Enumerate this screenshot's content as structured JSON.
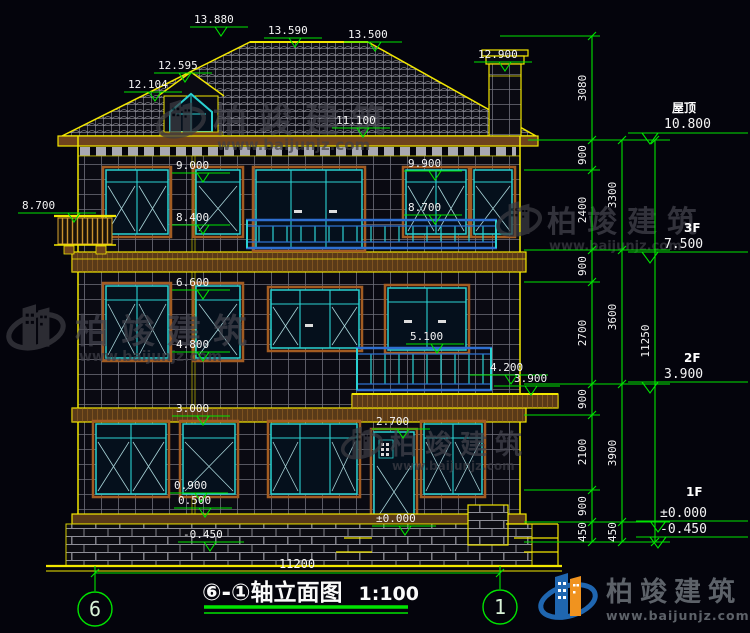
{
  "drawing_title": {
    "prefix": "⑥-①",
    "name": "轴立面图",
    "scale": "1:100"
  },
  "axis": {
    "left_bubble": "6",
    "right_bubble": "1",
    "overall_width": "11200"
  },
  "elevation_markers": [
    {
      "label": "13.880"
    },
    {
      "label": "13.590"
    },
    {
      "label": "13.500"
    },
    {
      "label": "12.900"
    },
    {
      "label": "12.595"
    },
    {
      "label": "12.104"
    },
    {
      "label": "11.100"
    },
    {
      "label": "9.000"
    },
    {
      "label": "9.900"
    },
    {
      "label": "8.700"
    },
    {
      "label": "8.400"
    },
    {
      "label": "8.700"
    },
    {
      "label": "6.600"
    },
    {
      "label": "4.800"
    },
    {
      "label": "5.100"
    },
    {
      "label": "4.200"
    },
    {
      "label": "3.900"
    },
    {
      "label": "3.000"
    },
    {
      "label": "2.700"
    },
    {
      "label": "0.900"
    },
    {
      "label": "0.500"
    },
    {
      "label": "±0.000"
    },
    {
      "label": "-0.450"
    }
  ],
  "right_dimensions": {
    "inner_chain": [
      "3080",
      "900",
      "2400",
      "900",
      "2700",
      "900",
      "2100",
      "900",
      "450"
    ],
    "mid_chain": [
      "3300",
      "3600",
      "3900",
      "450"
    ],
    "overall": "11250",
    "levels": [
      {
        "name": "屋顶",
        "elevation": "10.800"
      },
      {
        "name": "3F",
        "elevation": "7.500"
      },
      {
        "name": "2F",
        "elevation": "3.900"
      },
      {
        "name": "1F",
        "elevation": "±0.000"
      },
      {
        "name": "",
        "elevation": "-0.450"
      }
    ]
  },
  "watermark": {
    "brand": "柏竣建筑",
    "url": "www.baijunjz.com"
  },
  "footer_logo": {
    "brand": "柏竣建筑",
    "url": "www.baijunjz.com"
  },
  "colors": {
    "background": "#04040c",
    "cad_green": "#00e400",
    "cad_yellow": "#f2e700",
    "frame_cyan": "#2ad2d2",
    "trim_brown": "#a35c22",
    "railing_blue": "#2f6fd0",
    "text_white": "#f5f5f5"
  }
}
